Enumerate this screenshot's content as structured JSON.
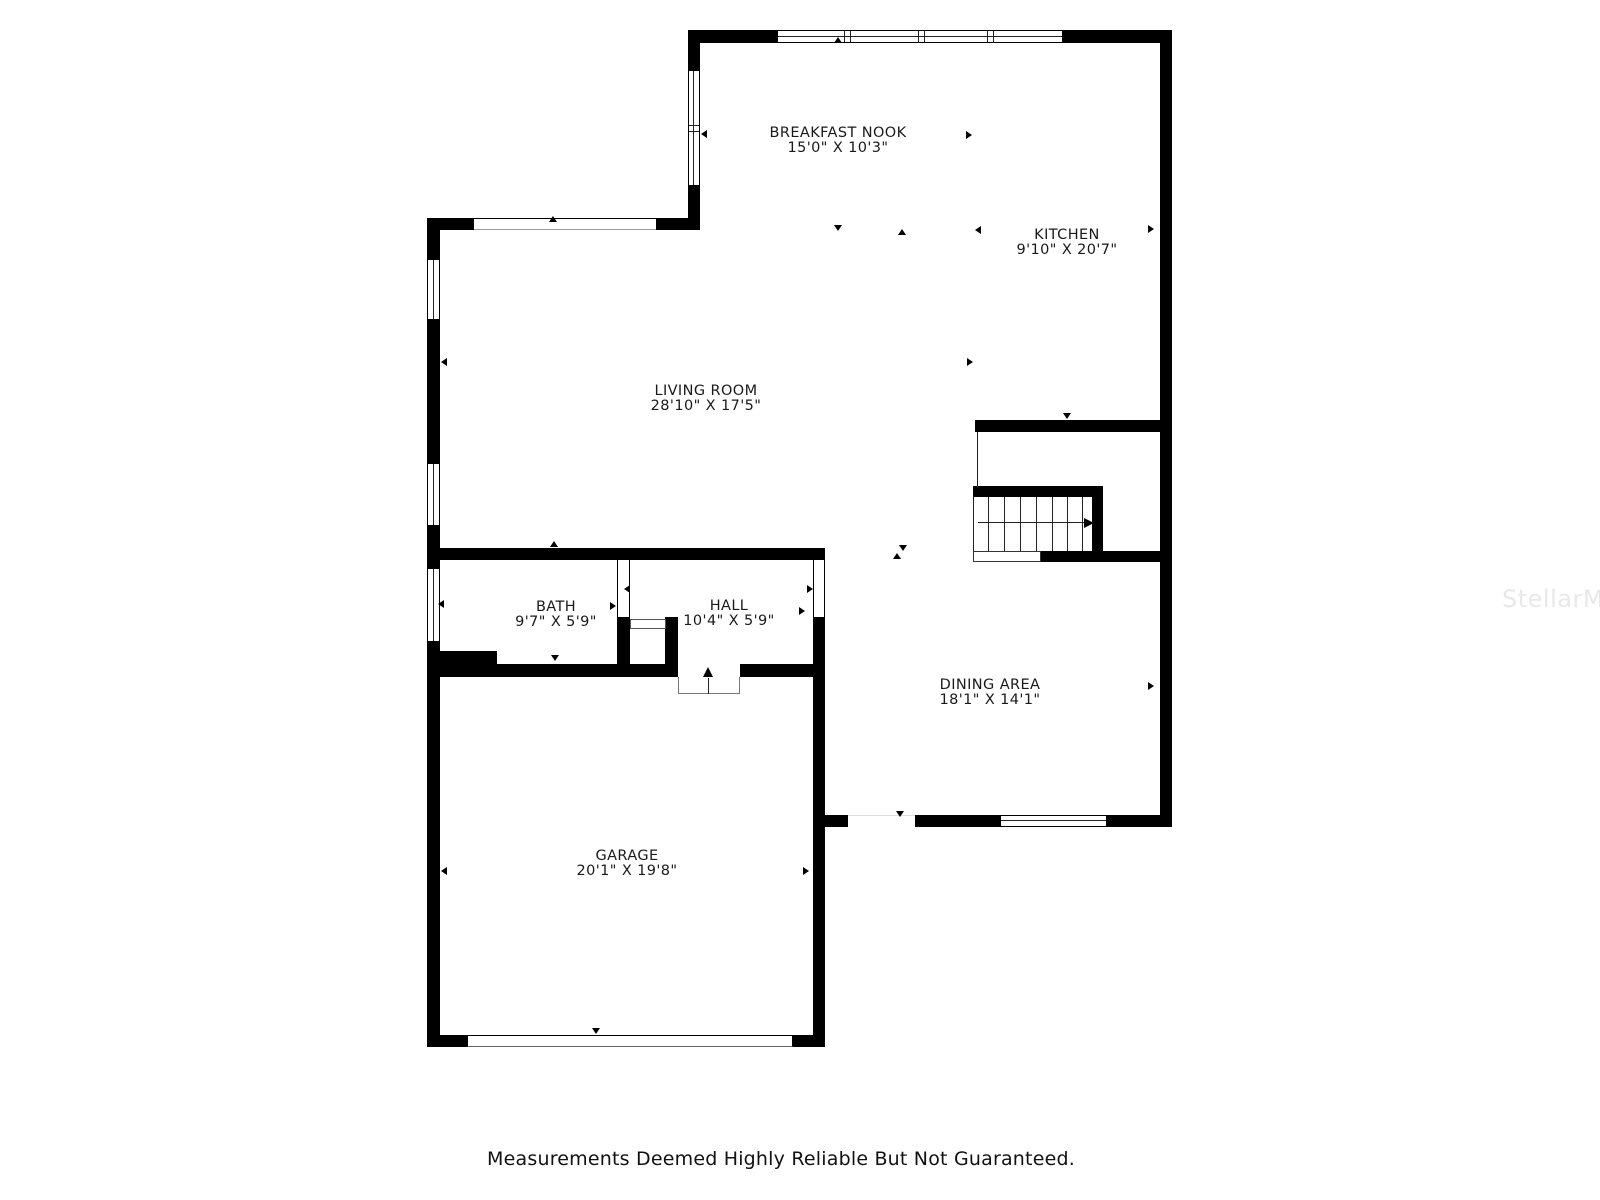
{
  "rooms": [
    {
      "id": "breakfast-nook",
      "name": "BREAKFAST NOOK",
      "dims": "15'0\" X 10'3\""
    },
    {
      "id": "kitchen",
      "name": "KITCHEN",
      "dims": "9'10\" X 20'7\""
    },
    {
      "id": "living-room",
      "name": "LIVING ROOM",
      "dims": "28'10\" X 17'5\""
    },
    {
      "id": "bath",
      "name": "BATH",
      "dims": "9'7\" X 5'9\""
    },
    {
      "id": "hall",
      "name": "HALL",
      "dims": "10'4\" X 5'9\""
    },
    {
      "id": "dining-area",
      "name": "DINING AREA",
      "dims": "18'1\" X 14'1\""
    },
    {
      "id": "garage",
      "name": "GARAGE",
      "dims": "20'1\" X 19'8\""
    }
  ],
  "watermark": "StellarMLS",
  "footer": {
    "disclaimer": "Measurements Deemed Highly Reliable But Not Guaranteed."
  },
  "colors": {
    "wall": "#000000",
    "background": "#ffffff",
    "watermark": "#e8e8e8",
    "text": "#1a1a1a"
  }
}
